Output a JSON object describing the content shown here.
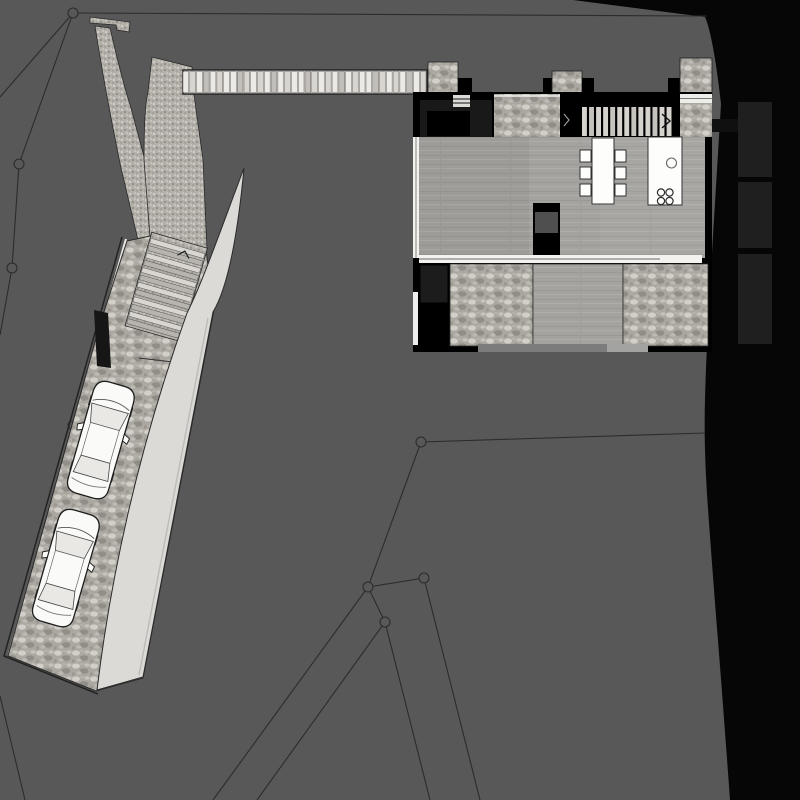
{
  "scene": {
    "kind": "architectural-site-plan",
    "canvas": {
      "width": 800,
      "height": 800
    }
  },
  "colors": {
    "site": "#585858",
    "terrain": "#060606",
    "line": "#2c2c2c",
    "wall": "#000000",
    "room_dark": "#1f1f1f",
    "entry_room": "#191919",
    "concrete": "#a4a3a0",
    "stone": "#aba7a1",
    "fine_stone": "#b3afa9",
    "ramp": "#dcdad6",
    "plank_light": "#eceae6",
    "plank_mid": "#d8d5d0",
    "plank_dark": "#c2bfba",
    "glass_white": "#f3f2ef",
    "furniture_white": "#fdfdfc",
    "tread": "#d6d3ce",
    "tread_alt": "#c6c3be",
    "door_gray": "#7c7c7c",
    "door_light": "#a3a3a1",
    "car_body": "#fafaf9",
    "car_glass": "#e9e8e5",
    "outline": "#1c1c1c",
    "slot_dark": "#161616",
    "core_band": "#4f4f4f"
  },
  "survey": {
    "points": [
      {
        "x": 73,
        "y": 13,
        "r": 5,
        "filled": true
      },
      {
        "x": 19,
        "y": 164,
        "r": 5,
        "filled": true
      },
      {
        "x": 12,
        "y": 268,
        "r": 5,
        "filled": true
      },
      {
        "x": 421,
        "y": 442,
        "r": 5,
        "filled": true
      },
      {
        "x": 368,
        "y": 587,
        "r": 5,
        "filled": true
      },
      {
        "x": 424,
        "y": 578,
        "r": 5,
        "filled": true
      },
      {
        "x": 385,
        "y": 622,
        "r": 5,
        "filled": true
      },
      {
        "x": 118,
        "y": 278,
        "r": 4,
        "filled": false
      },
      {
        "x": 72,
        "y": 425,
        "r": 4,
        "filled": false
      }
    ],
    "segments": [
      [
        73,
        13,
        707,
        16
      ],
      [
        73,
        13,
        0,
        97
      ],
      [
        73,
        13,
        19,
        164
      ],
      [
        19,
        164,
        12,
        268
      ],
      [
        12,
        268,
        0,
        335
      ],
      [
        0,
        696,
        25,
        800
      ],
      [
        421,
        442,
        705,
        433
      ],
      [
        421,
        442,
        368,
        587
      ],
      [
        368,
        587,
        424,
        578
      ],
      [
        368,
        587,
        213,
        800
      ],
      [
        424,
        578,
        480,
        800
      ],
      [
        368,
        587,
        385,
        622
      ],
      [
        385,
        622,
        257,
        800
      ],
      [
        385,
        622,
        430,
        800
      ]
    ]
  },
  "bridge": {
    "x": 183,
    "y": 70,
    "width": 244,
    "height": 24,
    "planks": 36
  },
  "building": {
    "interior_stairs": {
      "treads": 13,
      "x": 582,
      "y": 107,
      "tread_h": 29,
      "pitch": 7.05
    },
    "dining": {
      "chair_rows_y": [
        150,
        167,
        184
      ],
      "chair_size": 11,
      "left_chairs_x": 580,
      "right_chairs_x": 615
    },
    "kitchen": {
      "sink": {
        "cx": 671.5,
        "cy": 163,
        "r": 5
      },
      "burners": [
        {
          "cx": 661,
          "cy": 192.5
        },
        {
          "cx": 669.5,
          "cy": 192.5
        },
        {
          "cx": 661,
          "cy": 201
        },
        {
          "cx": 669.5,
          "cy": 201
        }
      ],
      "burner_r": 3.6
    },
    "east_rooms": [
      {
        "x": 738,
        "y": 102,
        "w": 34,
        "h": 75
      },
      {
        "x": 738,
        "y": 182,
        "w": 34,
        "h": 66
      },
      {
        "x": 738,
        "y": 254,
        "w": 34,
        "h": 90
      }
    ]
  },
  "driveway": {
    "angle_deg": 16,
    "site_stairs": {
      "cx": 178,
      "cy": 246,
      "treads": 12,
      "width": 56,
      "pitch": 7.6
    },
    "cars": [
      {
        "cx": 101,
        "cy": 440,
        "angle": 16
      },
      {
        "cx": 66,
        "cy": 568,
        "angle": 16
      }
    ]
  }
}
